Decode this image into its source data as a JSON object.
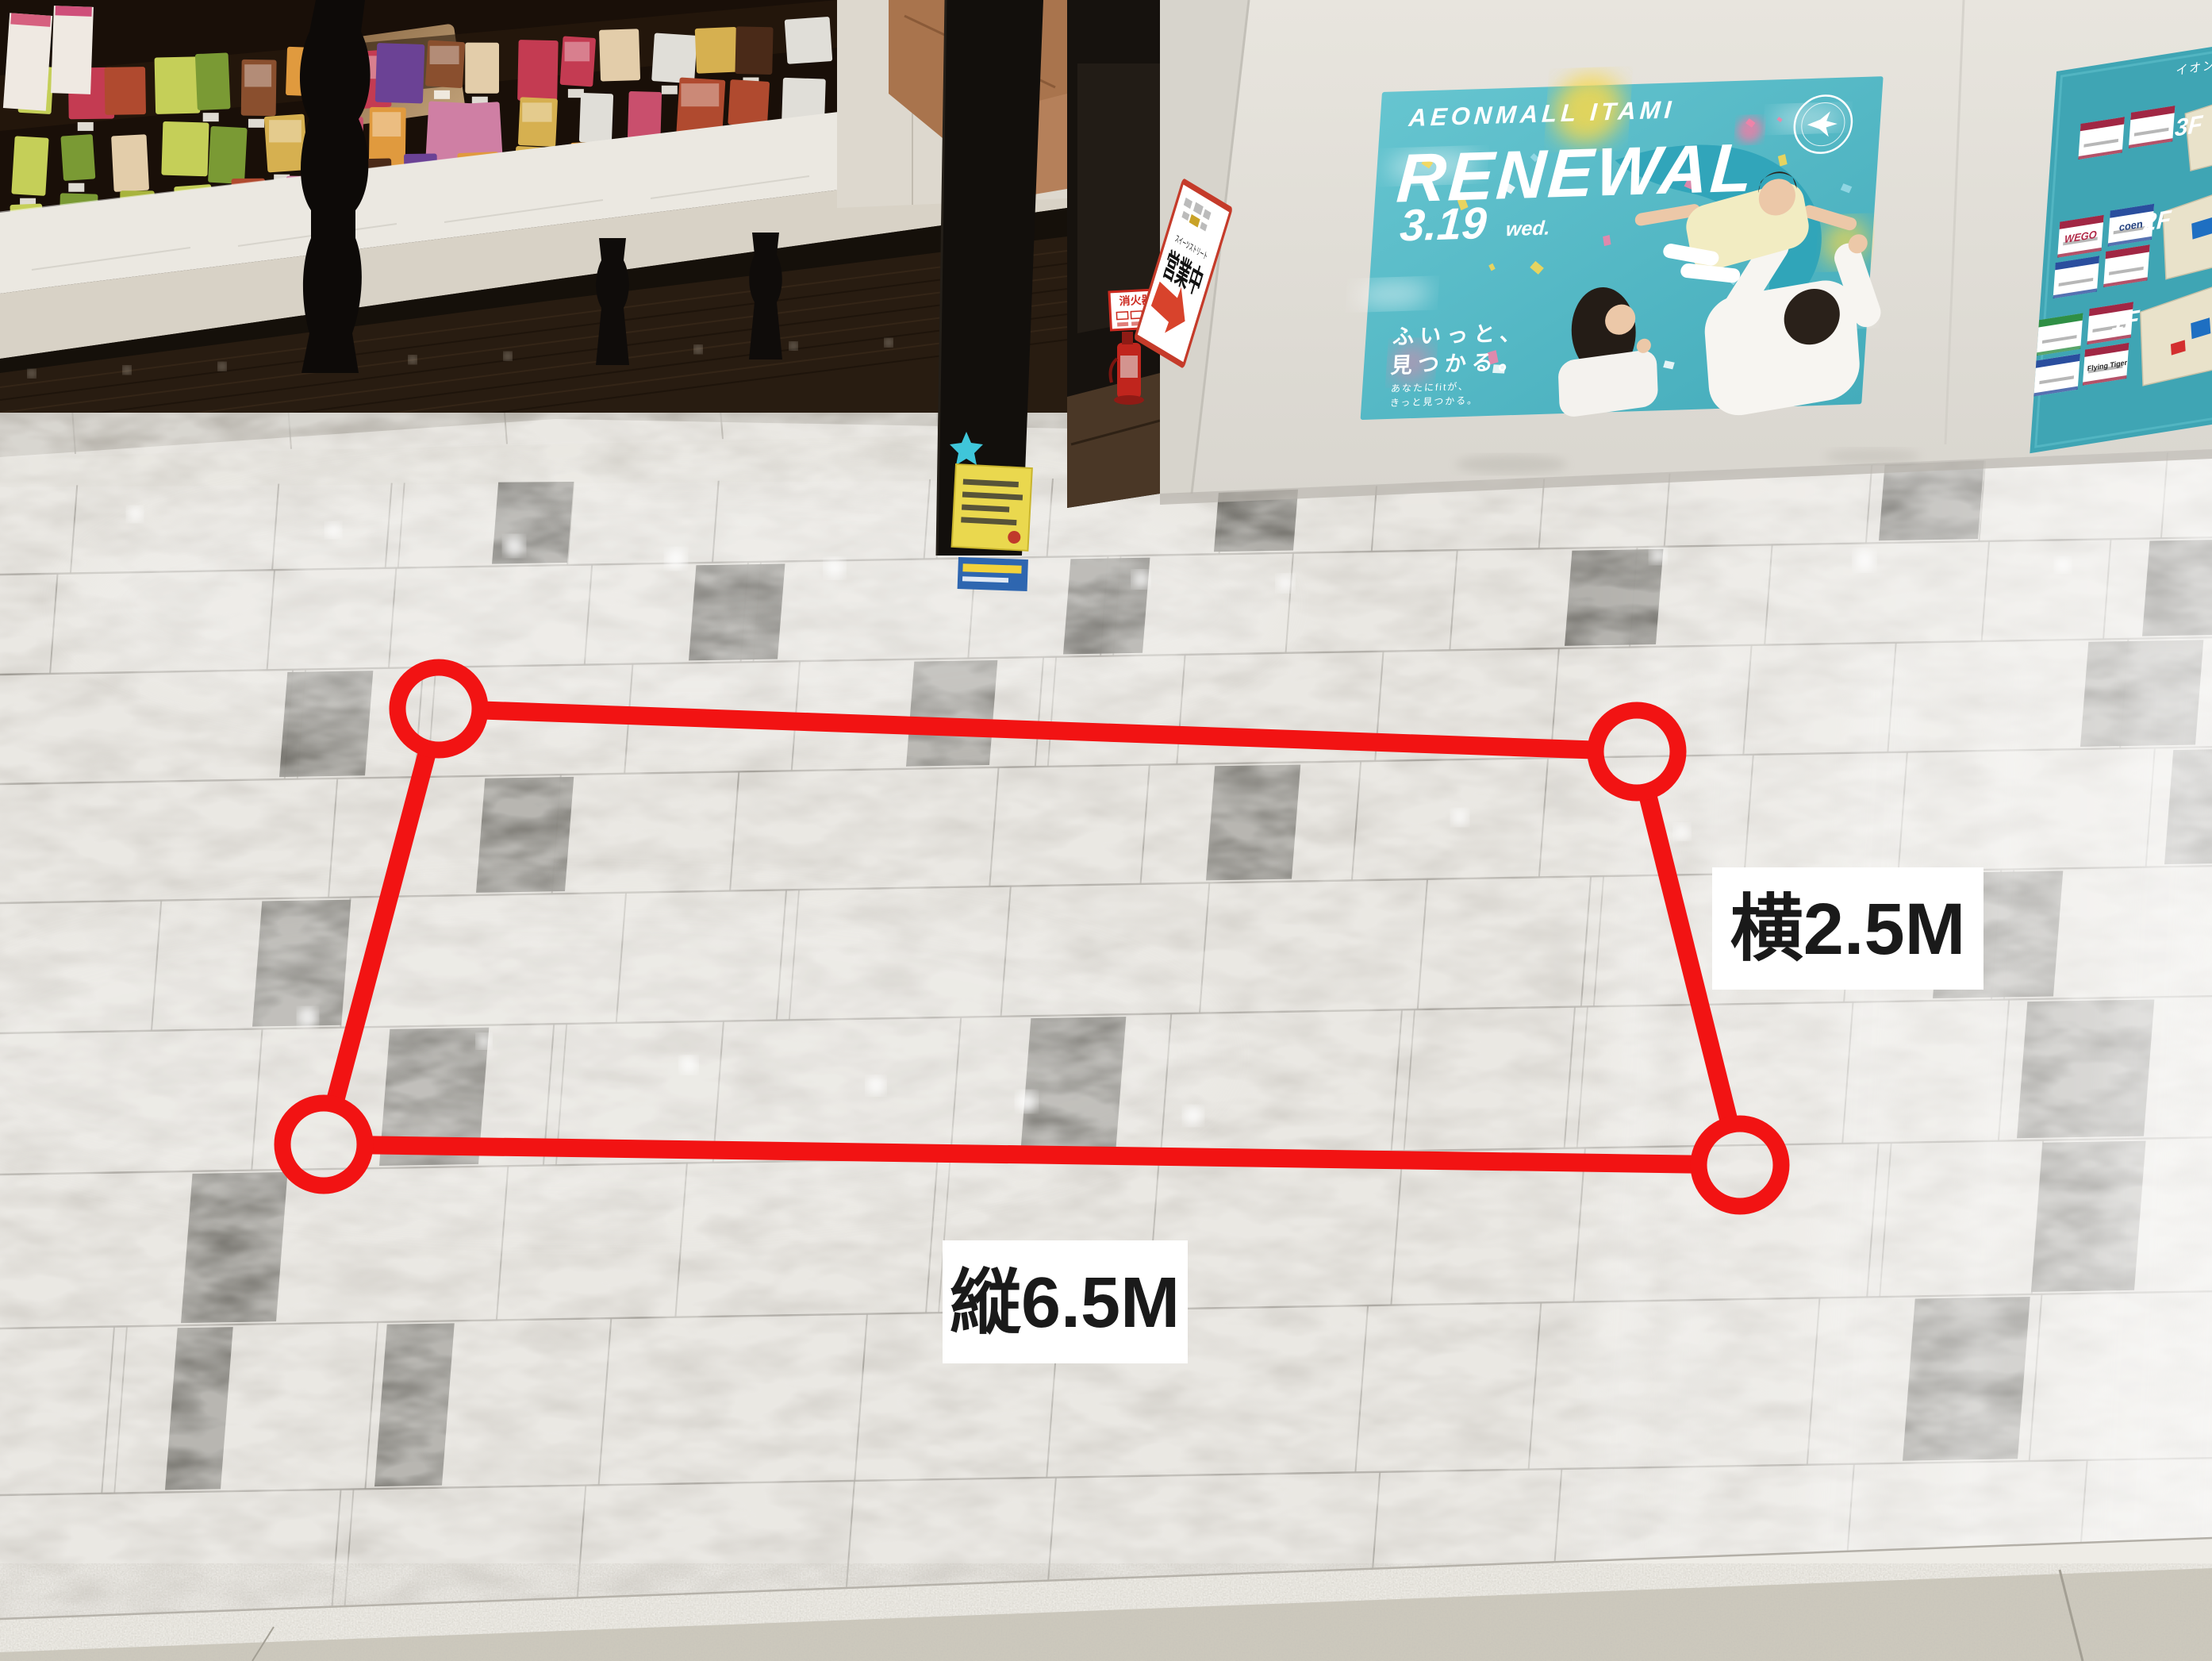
{
  "measurement": {
    "outline_color": "#f21313",
    "width_label": "横2.5M",
    "depth_label": "縦6.5M"
  },
  "open_sign": {
    "street": "スイーツストリート",
    "status": "営業中",
    "border_color": "#c53b2a"
  },
  "fire_sign": {
    "label": "消火器"
  },
  "renewal_poster": {
    "brand": "AEONMALL ITAMI",
    "title": "RENEWAL",
    "date": "3.19",
    "day": "wed.",
    "catch_line_1": "ふいっと、",
    "catch_line_2": "見つかる。",
    "sub_line_1": "あなたにfitが、",
    "sub_line_2": "きっと見つかる。",
    "bg_color": "#52b9c8"
  },
  "floor_map_poster": {
    "mall_name": "イオンモール伊丹",
    "floor_labels": [
      "3F",
      "2F",
      "1F"
    ],
    "visible_store_logos": [
      "WEGO",
      "coen",
      "Flying Tiger"
    ],
    "bg_color": "#3fa5b4"
  }
}
